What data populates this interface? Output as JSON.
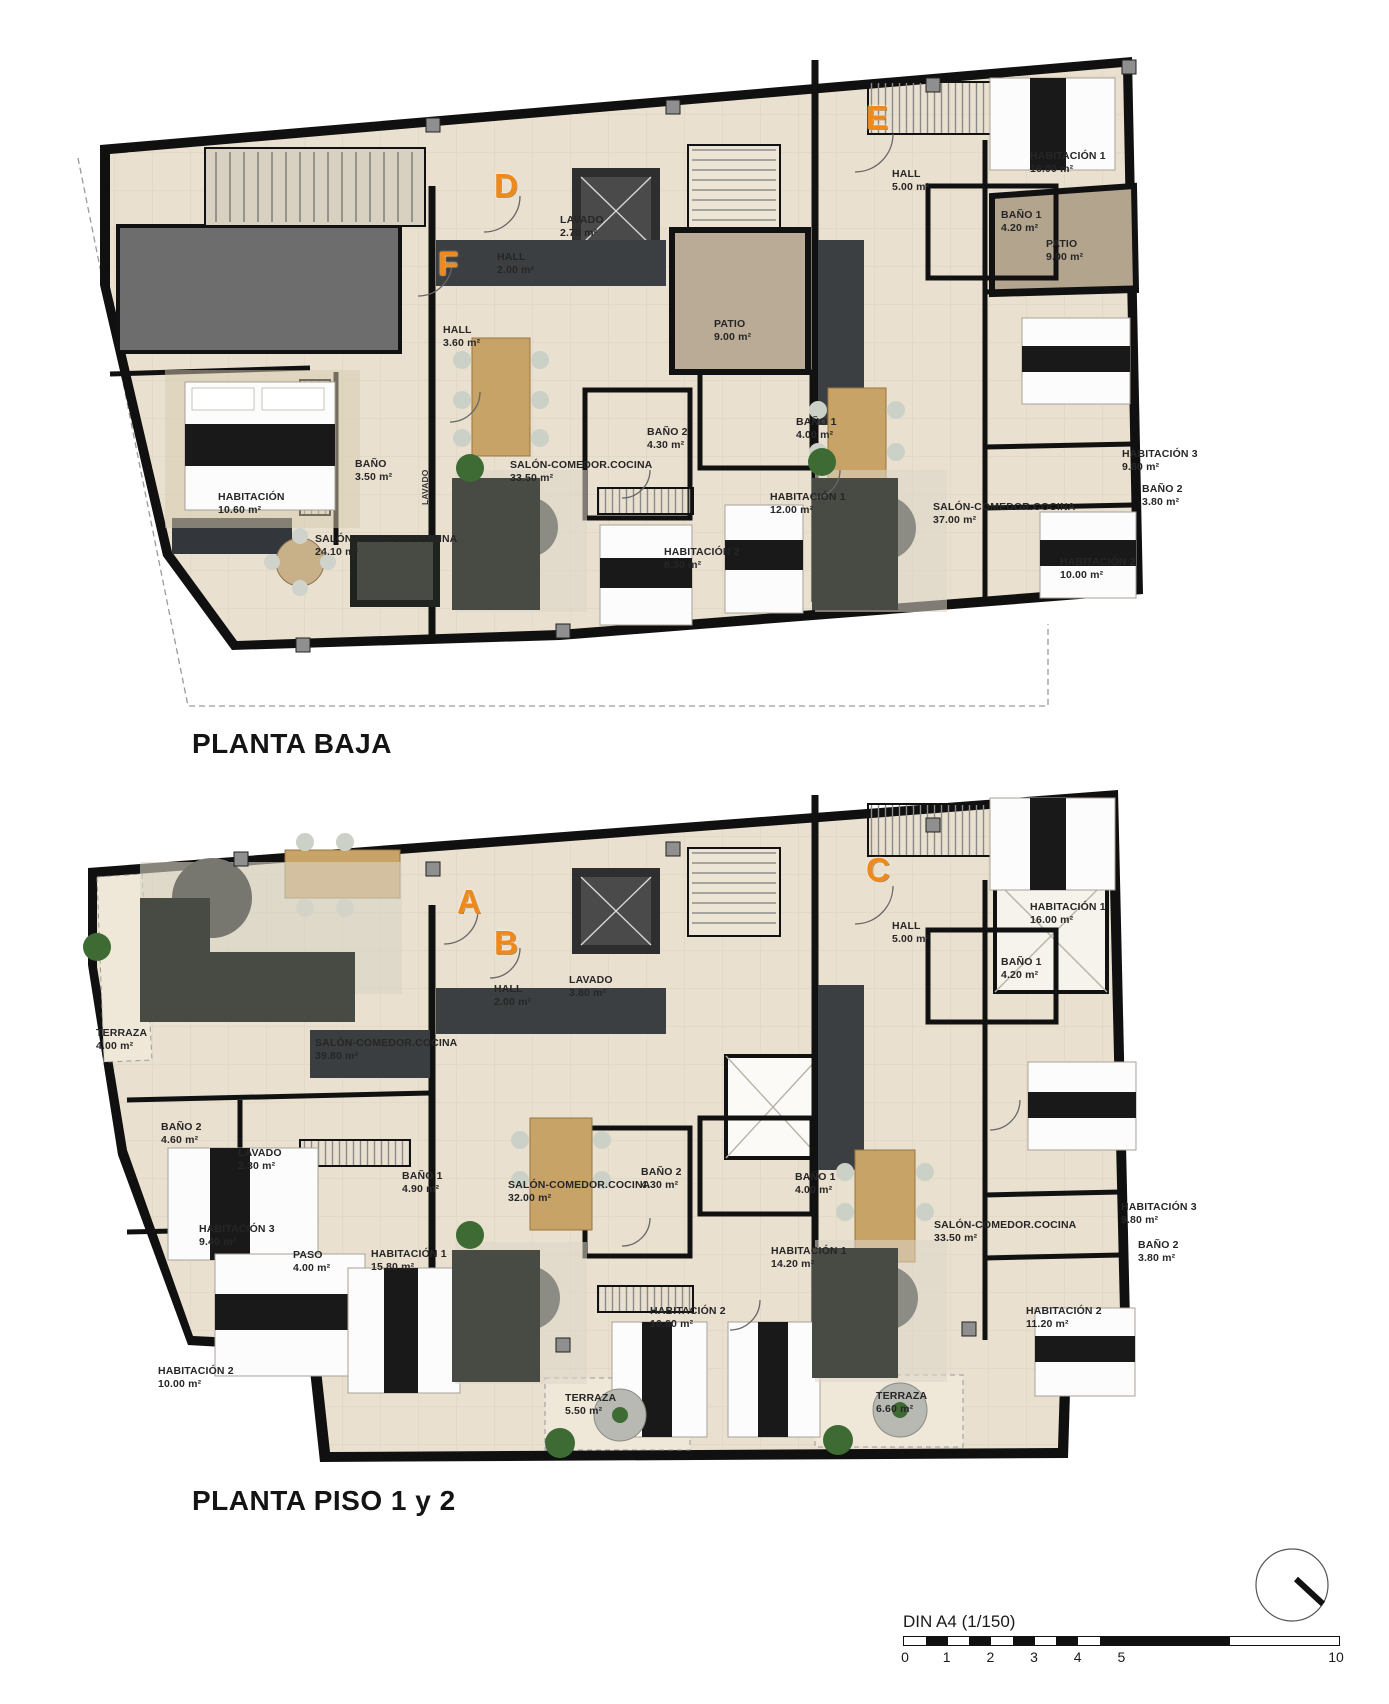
{
  "page": {
    "scale": {
      "label": "DIN A4 (1/150)",
      "ticks": [
        "0",
        "1",
        "2",
        "3",
        "4",
        "5",
        "10"
      ]
    },
    "colors": {
      "marker_orange": "#ee8a1c",
      "wall_black": "#111111",
      "floor_beige": "#e9e0cf",
      "patio_brown": "#b3a48e",
      "wood_tan": "#c8a368",
      "sofa_gray": "#474b43",
      "garage_gray": "#6d6d6d"
    }
  },
  "plans": [
    {
      "title": "PLANTA BAJA",
      "markers": [
        {
          "label": "F"
        },
        {
          "label": "D"
        },
        {
          "label": "E"
        }
      ],
      "rooms": [
        {
          "name": "HALL",
          "area": "5.00 m²"
        },
        {
          "name": "HABITACIÓN 1",
          "area": "16.00 m²"
        },
        {
          "name": "BAÑO 1",
          "area": "4.20 m²"
        },
        {
          "name": "PATIO",
          "area": "9.00 m²"
        },
        {
          "name": "LAVADO",
          "area": "2.70 m²"
        },
        {
          "name": "HALL",
          "area": "2.00 m²"
        },
        {
          "name": "HALL",
          "area": "3.60 m²"
        },
        {
          "name": "PATIO",
          "area": "9.00 m²"
        },
        {
          "name": "BAÑO",
          "area": "3.50 m²"
        },
        {
          "name": "HABITACIÓN",
          "area": "10.60 m²"
        },
        {
          "name": "SALÓN-COMEDOR.COCINA",
          "area": "24.10 m²"
        },
        {
          "name": "SALÓN-COMEDOR.COCINA",
          "area": "33.50 m²"
        },
        {
          "name": "BAÑO 2",
          "area": "4.30 m²"
        },
        {
          "name": "BAÑO 1",
          "area": "4.00 m²"
        },
        {
          "name": "HABITACIÓN 1",
          "area": "12.00 m²"
        },
        {
          "name": "HABITACIÓN 2",
          "area": "8.30 m²"
        },
        {
          "name": "SALÓN-COMEDOR.COCINA",
          "area": "37.00 m²"
        },
        {
          "name": "HABITACIÓN 3",
          "area": "9.80 m²"
        },
        {
          "name": "BAÑO 2",
          "area": "3.80 m²"
        },
        {
          "name": "HABITACIÓN 2",
          "area": "10.00 m²"
        },
        {
          "name": "LAVADO",
          "area": ""
        }
      ]
    },
    {
      "title": "PLANTA PISO 1 y 2",
      "markers": [
        {
          "label": "A"
        },
        {
          "label": "B"
        },
        {
          "label": "C"
        }
      ],
      "rooms": [
        {
          "name": "HALL",
          "area": "5.00 m²"
        },
        {
          "name": "HABITACIÓN 1",
          "area": "16.00 m²"
        },
        {
          "name": "BAÑO 1",
          "area": "4.20 m²"
        },
        {
          "name": "HALL",
          "area": "2.00 m²"
        },
        {
          "name": "LAVADO",
          "area": "3.80 m²"
        },
        {
          "name": "TERRAZA",
          "area": "4.00 m²"
        },
        {
          "name": "SALÓN-COMEDOR.COCINA",
          "area": "39.80 m²"
        },
        {
          "name": "BAÑO 2",
          "area": "4.60 m²"
        },
        {
          "name": "LAVADO",
          "area": "2.30 m²"
        },
        {
          "name": "BAÑO 1",
          "area": "4.90 m²"
        },
        {
          "name": "HABITACIÓN 3",
          "area": "9.40 m²"
        },
        {
          "name": "PASO",
          "area": "4.00 m²"
        },
        {
          "name": "HABITACIÓN 1",
          "area": "15.80 m²"
        },
        {
          "name": "HABITACIÓN 2",
          "area": "10.00 m²"
        },
        {
          "name": "SALÓN-COMEDOR.COCINA",
          "area": "32.00 m²"
        },
        {
          "name": "BAÑO 2",
          "area": "4.30 m²"
        },
        {
          "name": "BAÑO 1",
          "area": "4.00 m²"
        },
        {
          "name": "HABITACIÓN 1",
          "area": "14.20 m²"
        },
        {
          "name": "HABITACIÓN 2",
          "area": "10.60 m²"
        },
        {
          "name": "TERRAZA",
          "area": "5.50 m²"
        },
        {
          "name": "SALÓN-COMEDOR.COCINA",
          "area": "33.50 m²"
        },
        {
          "name": "HABITACIÓN 3",
          "area": "9.80 m²"
        },
        {
          "name": "BAÑO 2",
          "area": "3.80 m²"
        },
        {
          "name": "HABITACIÓN 2",
          "area": "11.20 m²"
        },
        {
          "name": "TERRAZA",
          "area": "6.60 m²"
        }
      ]
    }
  ]
}
